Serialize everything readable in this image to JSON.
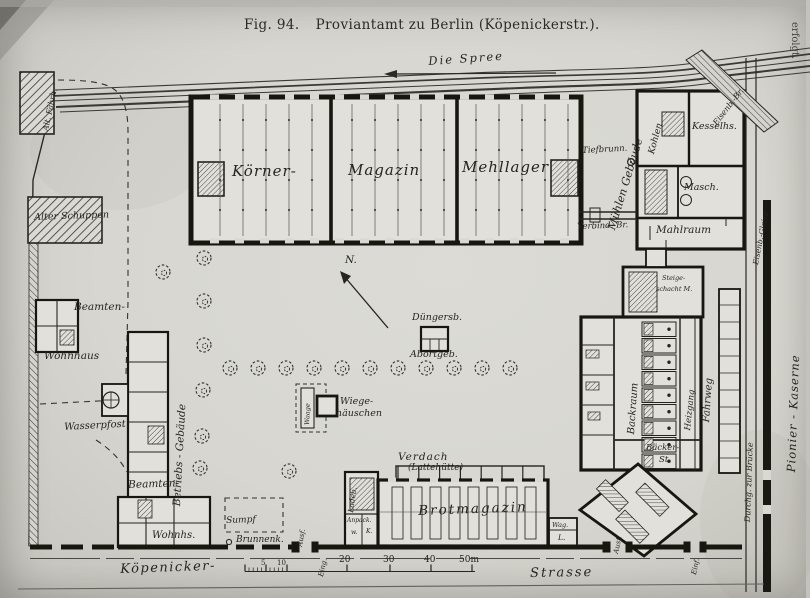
{
  "figure": {
    "caption": "Fig. 94.",
    "title": "Proviantamt zu Berlin (Köpenickerstr.)."
  },
  "river": {
    "name": "Die Spree"
  },
  "compass": {
    "north": "N."
  },
  "margin": {
    "right_text": "erfolgt."
  },
  "site": {
    "alt_faehrh": "Alt. Fährh.",
    "alter_schuppen": "Alter Schuppen",
    "beamten_wohnhaus": {
      "l1": "Beamten-",
      "l2": "Wohnhaus"
    },
    "betriebs_gebaeude": "Betriebs - Gebäude",
    "wasserpfost": "Wasserpfost.",
    "beamten_wohnhs": {
      "l1": "Beamten-",
      "l2": "Wohnhs."
    },
    "sumpf": "Sumpf",
    "brunnenk": "Brunnenk.",
    "magazin": {
      "l1": "Körner-",
      "l2": "Magazin",
      "l3": "Mehllager"
    },
    "duengersb": "Düngersb.",
    "abortgeb": "Abortgeb.",
    "wiege": {
      "l1": "Wiege-",
      "l2": "häuschen",
      "waage": "Waage"
    },
    "muehlen": "Mühlen Gebäude",
    "tiefbrunn": "Tiefbrunn.",
    "kohlen": "Kohlen",
    "kesselhaus": "Kesselhs.",
    "masch": "Masch.",
    "mahlraum": "Mahlraum",
    "verbind_br": "Verbind.-Br.",
    "steigeschacht": {
      "l1": "Steige-",
      "l2": "schacht M."
    },
    "backraum": "Backraum",
    "heizgang": "Heizgang",
    "baecker": {
      "l1": "Bäcker-",
      "l2": "St."
    },
    "fahrweg": "Fahrweg",
    "verdach": {
      "l1": "Verdach",
      "l2": "(Lattehütte)"
    },
    "brotmagazin": "Brotmagazin",
    "ladeb": "Ladeb.",
    "anpack": "Anpack.",
    "cell_w": "w.",
    "cell_k": "K.",
    "wag": {
      "l1": "Wag.",
      "l2": "L."
    }
  },
  "streets": {
    "koepenicker": "Köpenicker-",
    "strasse": "Strasse",
    "eisenb_br": "Eisenb.-Br.",
    "eisenb_gleise": "Eisenb.-Gleise",
    "durchgang": "Durchg. zur Brücke",
    "pionier_kaserne": "Pionier - Kaserne"
  },
  "gates": {
    "eing": "Eing.",
    "ausf_left": "Ausf.",
    "ausf_mid": "Ausf.",
    "einf": "Einf."
  },
  "scale_bar": {
    "t5": "5",
    "t10": "10",
    "t20": "20",
    "t30": "30",
    "t40": "40",
    "t50": "50m"
  },
  "ink": {
    "line": "#26251f",
    "paper": "#d9d8d2"
  }
}
